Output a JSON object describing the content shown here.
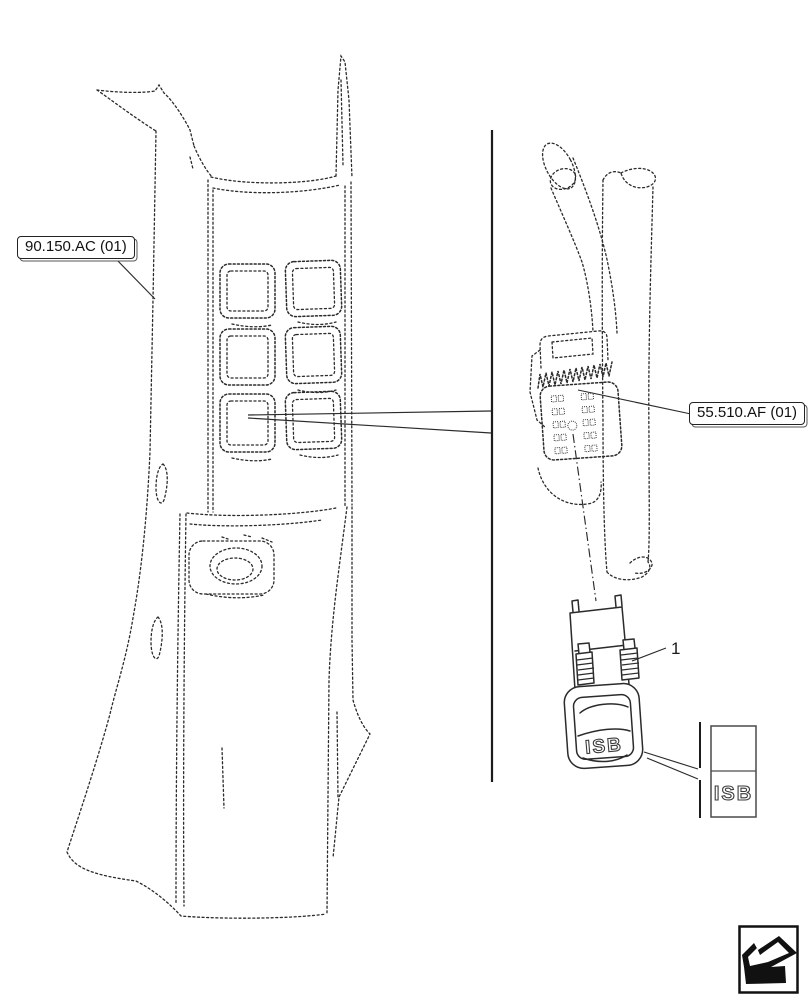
{
  "diagram": {
    "references": {
      "left": "90.150.AC (01)",
      "right": "55.510.AF (01)"
    },
    "callouts": {
      "item_1": "1"
    },
    "switch": {
      "label": "ISB"
    },
    "legend": {
      "label": "ISB"
    },
    "icons": {
      "corner": "return-arrow-icon"
    },
    "colors": {
      "line": "#2b2b2b",
      "background": "#ffffff"
    }
  }
}
